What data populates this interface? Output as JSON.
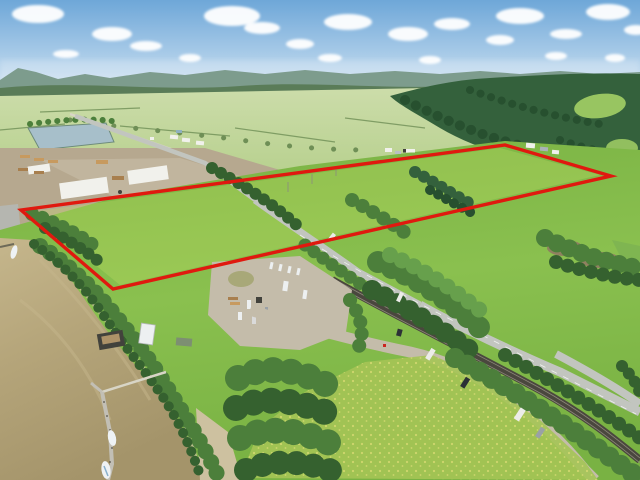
{
  "scene": {
    "type": "aerial-drone-photo",
    "description": "Aerial view of riverfront farmland acreage outlined with a red property boundary, beside a muddy river with a dock, an industrial lumber yard, a road and railway corridor, forests and meadows under a blue sky with cumulus clouds",
    "objects": {
      "property_boundary": "red outlined quadrilateral over green fields",
      "river": "muddy tan river along lower left with L-shaped dock and two white boats",
      "dock_items": [
        "barge with dark equipment",
        "white RV trailer at shore",
        "green-roof trailer"
      ],
      "industrial_yard": "lumber storage yard with white-roofed buildings and stacked lumber",
      "pond": "grey-blue settling pond upper left",
      "corridor": [
        "paved road",
        "double-track railway",
        "gravel frontage road"
      ],
      "parked_vehicles": [
        "white van",
        "dark car with trailer",
        "white camper",
        "grey car"
      ],
      "staging_area": "gravel lot with RV trailers, logs and machinery",
      "meadow": "yellow-flower meadow in foreground",
      "clouds": "scattered white cumulus"
    }
  },
  "boundary": {
    "points_str": "21,210 505,145 611,176 113,289",
    "stroke_width": "3.4"
  },
  "palette": {
    "sky_top": "#6ea7d8",
    "sky_mid": "#a9cbe8",
    "sky_horizon": "#ddeaf4",
    "cloud_white": "#ffffff",
    "hills_far": "#7d9c8d",
    "forest_far": "#587a55",
    "conifer_dark": "#34613c",
    "conifer_shadow": "#27502f",
    "clearing_green": "#a3d065",
    "valley_far": "#cdddab",
    "valley_near": "#a9c87b",
    "hedgerow": "#6f8f56",
    "field_bright": "#8ac04f",
    "field_deep": "#79b243",
    "property_highlight": "#c8e468",
    "tree_dark": "#35612f",
    "tree_mid": "#4c7f3b",
    "tree_light": "#67a04c",
    "pond_water": "#a7bfca",
    "river_water": "#b5a57a",
    "river_deep": "#a4946a",
    "river_light": "#c5b68c",
    "sand": "#cdc1a0",
    "road_paved": "#c2c5bf",
    "road_light": "#d8d5c6",
    "road_stripe": "#f0f2ef",
    "railway_dark": "#4a473e",
    "rail_metal": "#8d887a",
    "gravel": "#c4bcaa",
    "industrial_ground": "#b6a88f",
    "roof_white": "#f1f1ec",
    "lumber_tan": "#c79a5f",
    "lumber_brown": "#a87f4e",
    "machinery_dark": "#42423c",
    "boundary_red": "#e0190f",
    "vehicle_white": "#ecece8",
    "vehicle_dark": "#2c3136",
    "vehicle_gray": "#9aa1a6",
    "boat_white": "#eef2f4",
    "boat_blue": "#88b0cc",
    "rv_white": "#edf0f1",
    "trailer_green": "#7d8f72",
    "flower_yellow": "#d6d972",
    "meadow_green": "#a5c455",
    "slough_brown": "#8f8060",
    "lawn_green": "#7fb551"
  }
}
